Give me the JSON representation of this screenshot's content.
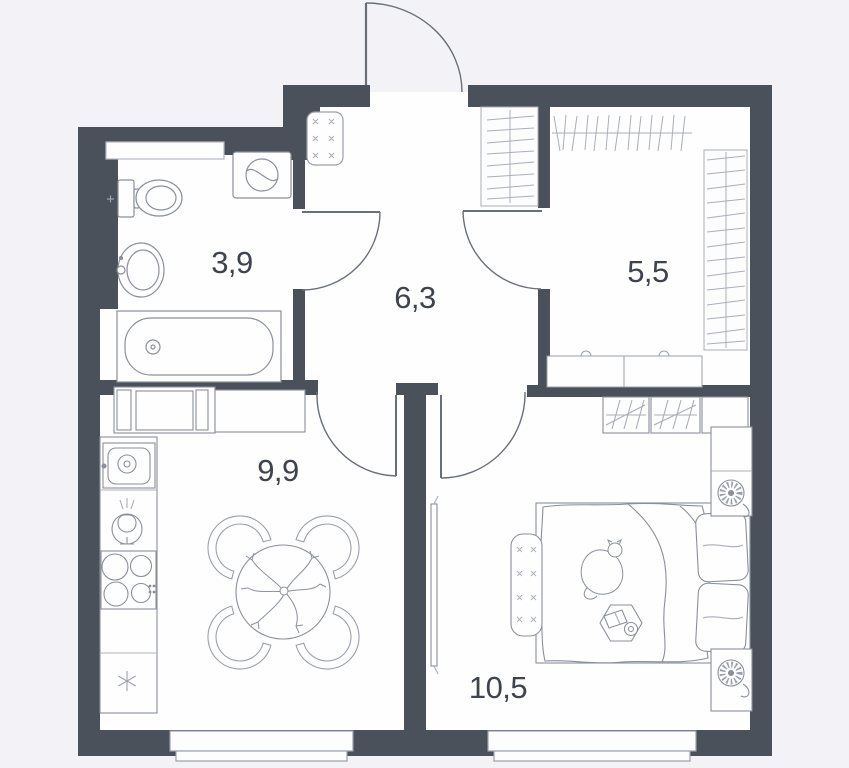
{
  "plan": {
    "type": "apartment-floor-plan",
    "rooms": {
      "bathroom": {
        "name": "bathroom",
        "area": "3,9"
      },
      "hallway": {
        "name": "hallway",
        "area": "6,3"
      },
      "wardrobe": {
        "name": "wardrobe-room",
        "area": "5,5"
      },
      "kitchen": {
        "name": "kitchen-living",
        "area": "9,9"
      },
      "bedroom": {
        "name": "bedroom",
        "area": "10,5"
      }
    },
    "colors": {
      "wall": "#4b515b",
      "background": "#f3f2f7",
      "room_fill": "#fefefe",
      "fixture_outline": "#8a909b",
      "hatch_line": "#9ba0aa",
      "label_text": "#3e434d"
    },
    "fixtures": {
      "bathroom": [
        "toilet",
        "bathroom-sink",
        "bathtub",
        "washing-machine",
        "wall-shelf"
      ],
      "hallway": [
        "shoe-cabinet",
        "coat-rack"
      ],
      "wardrobe_room": [
        "clothes-rail-top",
        "clothes-rail-right",
        "low-cabinets"
      ],
      "kitchen": [
        "laundry-cabinet",
        "worktop",
        "kitchen-sink",
        "cooker-hood",
        "stove",
        "fridge",
        "dining-table",
        "dining-chairs",
        "table-plant"
      ],
      "bedroom": [
        "built-in-wardrobe",
        "tv",
        "double-bed",
        "pillows",
        "cat",
        "bedside-bench",
        "side-table",
        "nightstand-top",
        "nightstand-bottom",
        "table-lamps"
      ],
      "openings": [
        "entrance-door",
        "bathroom-door",
        "kitchen-door",
        "bedroom-door",
        "wardrobe-door",
        "kitchen-window",
        "bedroom-window"
      ]
    }
  }
}
